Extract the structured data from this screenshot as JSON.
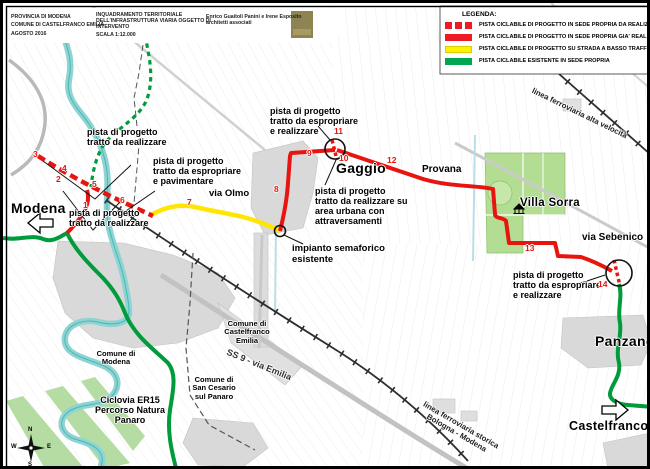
{
  "title_block": {
    "col1": "PROVINCIA DI MODENA\nCOMUNE DI CASTELFRANCO EMILIA\nAGOSTO 2016",
    "col2_desc": "INQUADRAMENTO TERRITORIALE\nDELL'INFRASTRUTTURA VIARIA OGGETTO DI\nINTERVENTO",
    "col2_scale": "SCALA 1:12.000",
    "col3": "Enrico Guaitoli Panini e Irene Esposito\narchitetti associati"
  },
  "legend": {
    "title": "LEGENDA:",
    "items": [
      {
        "label": "PISTA CICLABILE DI PROGETTO IN SEDE PROPRIA DA REALIZZARE",
        "style": "dashed-red",
        "color": "#ed1c24"
      },
      {
        "label": "PISTA CICLABILE DI PROGETTO IN SEDE PROPRIA GIA' REALIZZATA",
        "style": "solid-red",
        "color": "#ed1c24"
      },
      {
        "label": "PISTA CICLABILE DI PROGETTO SU STRADA A BASSO TRAFFICO",
        "style": "solid-yellow",
        "color": "#fff200"
      },
      {
        "label": "PISTA CICLABILE ESISTENTE IN SEDE PROPRIA",
        "style": "solid-green",
        "color": "#00a650"
      }
    ]
  },
  "map": {
    "towns": {
      "modena": "Modena",
      "gaggio": "Gaggio",
      "panzano": "Panzano",
      "castelfranco": "Castelfranco",
      "villa_sorra": "Villa Sorra"
    },
    "roads": {
      "via_olmo": "via Olmo",
      "provana": "Provana",
      "via_sebenico": "via Sebenico",
      "ss9": "SS 9 - via Emilia"
    },
    "railways": {
      "av": "linea ferroviaria alta velocità",
      "storica": "linea ferroviaria storica\nBologna - Modena"
    },
    "areas": {
      "comune_modena": "Comune di\nModena",
      "comune_castelfranco": "Comune di\nCastelfranco\nEmilia",
      "comune_san_cesario": "Comune di\nSan Cesario\nsul Panaro",
      "ciclovia": "Ciclovia ER15\nPercorso Natura\nPanaro"
    },
    "annotations": {
      "a1": "pista di progetto\ntratto da realizzare",
      "a2": "pista di progetto\ntratto da espropriare\ne pavimentare",
      "a3": "pista di progetto\ntratto da realizzare",
      "a4": "pista di progetto\ntratto da espropriare\ne realizzare",
      "a5": "pista di progetto\ntratto da realizzare su\narea urbana con\nattraversamenti",
      "a6": "impianto semaforico\nesistente",
      "a7": "pista di progetto\ntratto da espropriare\ne realizzare"
    },
    "waypoints": [
      "1",
      "2",
      "3",
      "4",
      "5",
      "6",
      "7",
      "8",
      "9",
      "10",
      "11",
      "12",
      "13",
      "14"
    ],
    "compass": {
      "n": "N",
      "e": "E",
      "s": "S",
      "w": "W"
    },
    "colors": {
      "route_new_dashed": "#e8140f",
      "route_done": "#e8140f",
      "route_low_traffic": "#ffe600",
      "route_existing": "#009b3a",
      "river": "#8ed4d2",
      "park": "#b2dd92",
      "urban": "#d9d9d9"
    }
  }
}
